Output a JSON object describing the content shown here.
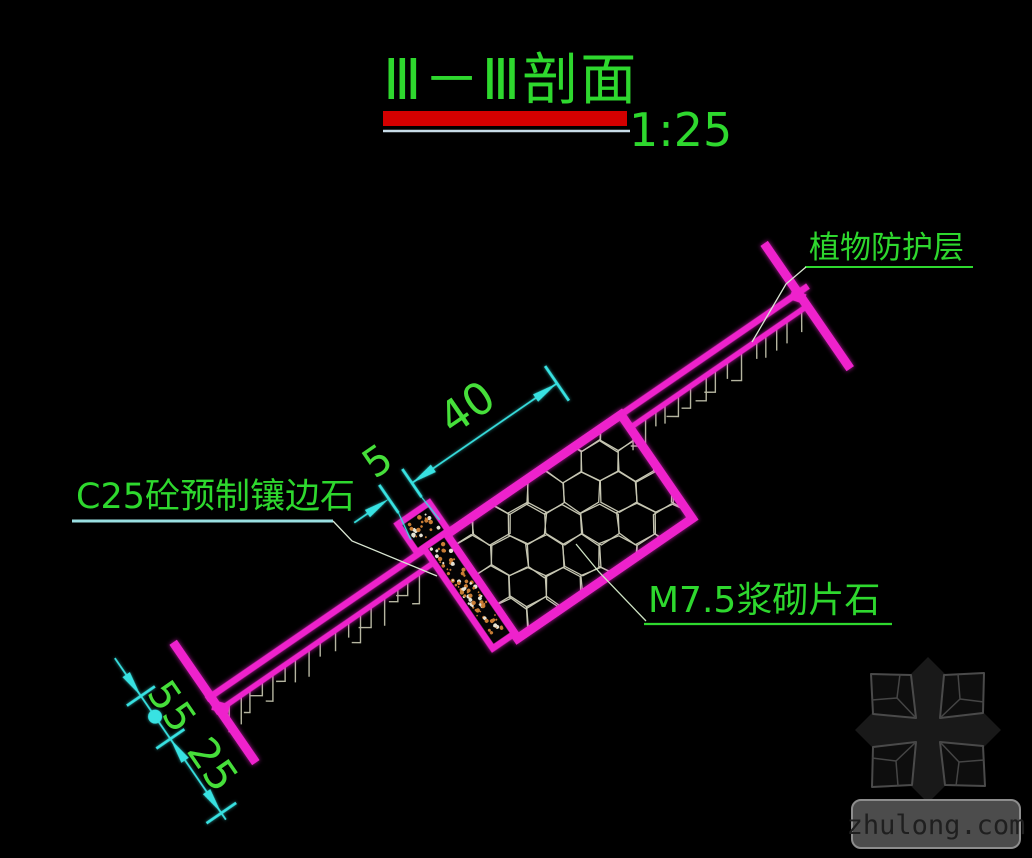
{
  "title": {
    "text": "Ⅲ－Ⅲ剖面",
    "scale": "1:25"
  },
  "labels": {
    "top": "植物防护层",
    "left": "C25砼预制镶边石",
    "right": "M7.5浆砌片石"
  },
  "dimensions": {
    "slope_length": "40",
    "edging_width": "5",
    "chain": [
      "5",
      "5",
      "25"
    ]
  },
  "watermark": {
    "text": "zhulong.com"
  },
  "colors": {
    "background": "#000000",
    "structure_magenta": "#ee22cc",
    "text_green": "#2ed82e",
    "dimension_cyan": "#38e2e2",
    "title_bar_red": "#d40000",
    "hatch_gray": "#c6c6b2",
    "speckle_orange": "#c97d35"
  }
}
